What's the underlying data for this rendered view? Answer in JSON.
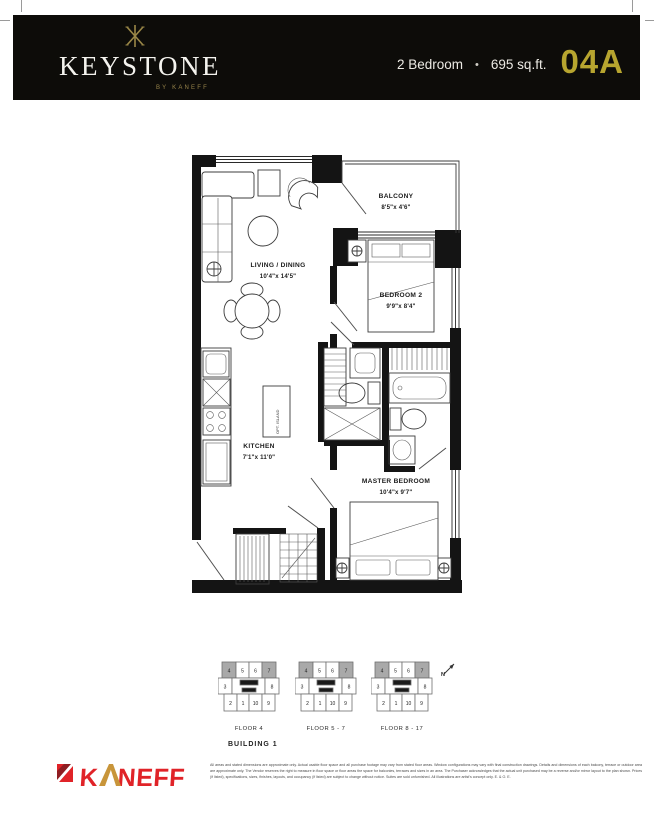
{
  "header": {
    "brand_name": "KEYSTONE",
    "brand_byline": "BY KANEFF",
    "unit_type": "2 Bedroom",
    "bullet": "•",
    "area": "695 sq.ft.",
    "unit_code": "04A",
    "colors": {
      "bar_bg": "#0d0c09",
      "gold": "#97844a",
      "unit_gold": "#b7a52f"
    }
  },
  "floorplan": {
    "living": {
      "name": "LIVING / DINING",
      "dims": "10'4\"x 14'5\""
    },
    "balcony": {
      "name": "BALCONY",
      "dims": "8'5\"x 4'6\""
    },
    "bedroom2": {
      "name": "BEDROOM 2",
      "dims": "9'9\"x 8'4\""
    },
    "kitchen": {
      "name": "KITCHEN",
      "dims": "7'1\"x 11'0\""
    },
    "master": {
      "name": "MASTER BEDROOM",
      "dims": "10'4\"x 9'7\""
    },
    "island_label": "OPT. ISLAND"
  },
  "keyplan": {
    "floors": [
      "FLOOR 4",
      "FLOOR 5 - 7",
      "FLOOR 8 - 17"
    ],
    "building": "BUILDING 1",
    "north": "N",
    "units_top": [
      "4",
      "5",
      "6",
      "7"
    ],
    "units_mid": [
      "3",
      "8"
    ],
    "units_bottom": [
      "2",
      "1",
      "10",
      "9"
    ],
    "highlighted_units": [
      "4",
      "7"
    ],
    "highlight_color": "#a9a9a9"
  },
  "footer": {
    "logo_k": "K",
    "logo_neff": "NEFF",
    "logo_color": "#e02328",
    "logo_gold": "#c8953a",
    "disclaimer": "All areas and stated dimensions are approximate only. Actual usable floor space and all purchase footage may vary from stated floor areas. Window configurations may vary with final construction drawings. Details and dimensions of each balcony, terrace or outdoor area are approximate only. The Vendor reserves the right to measure in floor space or floor areas the space for balconies, terraces and sizes in an area. The Purchaser acknowledges that the actual unit purchased may be a reverse and/or mirror layout to the plan shown. Prices (if listed), specifications, sizes, finishes, layouts, and occupancy (if listed) are subject to change without notice. Suites are sold unfurnished. All illustrations are artist's concept only. E. & O. E."
  }
}
